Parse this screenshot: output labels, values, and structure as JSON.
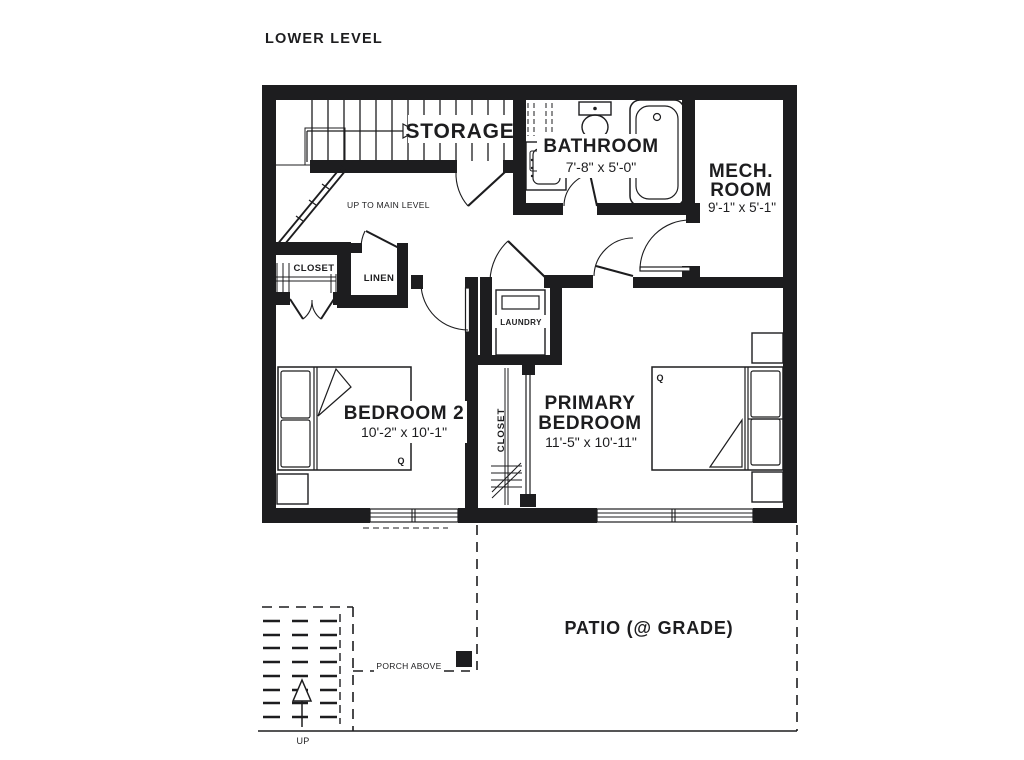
{
  "title": "LOWER LEVEL",
  "colors": {
    "ink": "#1d1d1f",
    "paper": "#ffffff"
  },
  "rooms": {
    "storage": {
      "label": "STORAGE"
    },
    "bathroom": {
      "label": "BATHROOM",
      "dims": "7'-8\" x 5'-0\""
    },
    "mech_room": {
      "label_line1": "MECH.",
      "label_line2": "ROOM",
      "dims": "9'-1\" x 5'-1\""
    },
    "hall_closet": {
      "label": "CLOSET"
    },
    "linen": {
      "label": "LINEN"
    },
    "laundry": {
      "label": "LAUNDRY"
    },
    "bedroom2": {
      "label": "BEDROOM 2",
      "dims": "10'-2\" x 10'-1\"",
      "bed_tag": "Q"
    },
    "primary_bedroom": {
      "label_line1": "PRIMARY",
      "label_line2": "BEDROOM",
      "dims": "11'-5\" x 10'-11\"",
      "bed_tag": "Q"
    },
    "primary_closet": {
      "label": "CLOSET"
    },
    "patio": {
      "label": "PATIO (@ GRADE)"
    }
  },
  "annotations": {
    "up_to_main_level": "UP TO MAIN LEVEL",
    "porch_above": "PORCH ABOVE",
    "up": "UP"
  }
}
